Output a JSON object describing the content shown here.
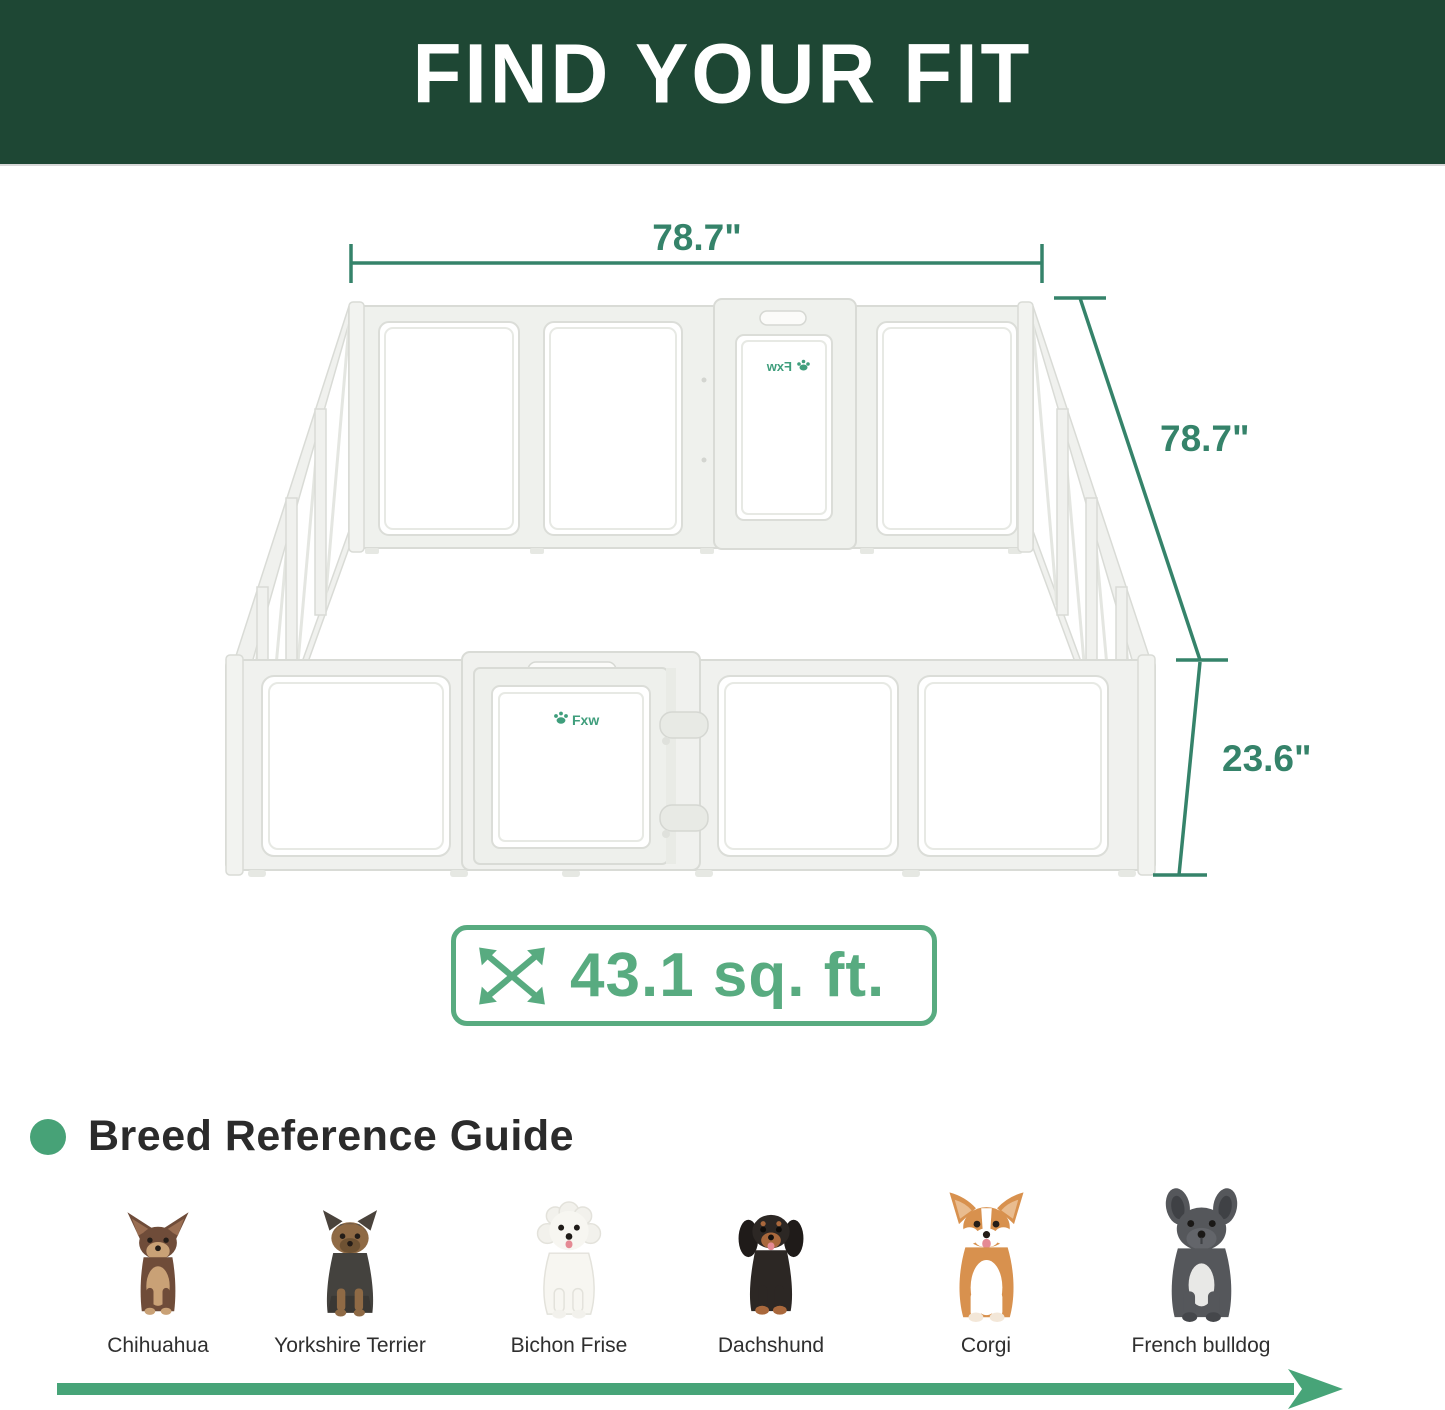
{
  "header": {
    "title": "FIND YOUR FIT"
  },
  "colors": {
    "header_bg": "#1E4734",
    "dimension_green": "#35836A",
    "badge_green": "#58AB80",
    "heading_dot_green": "#47A277",
    "arrow_green": "#47A478",
    "brand_green": "#3F9E7C",
    "text_dark": "#2B2B2B"
  },
  "diagram": {
    "width_label": "78.7\"",
    "depth_label": "78.7\"",
    "height_label": "23.6\"",
    "area_label": "43.1 sq. ft.",
    "brand_front": "Fxw",
    "brand_back": "Fxw"
  },
  "breed_guide": {
    "heading": "Breed Reference Guide",
    "breeds": [
      {
        "name": "Chihuahua"
      },
      {
        "name": "Yorkshire Terrier"
      },
      {
        "name": "Bichon Frise"
      },
      {
        "name": "Dachshund"
      },
      {
        "name": "Corgi"
      },
      {
        "name": "French bulldog"
      }
    ]
  }
}
